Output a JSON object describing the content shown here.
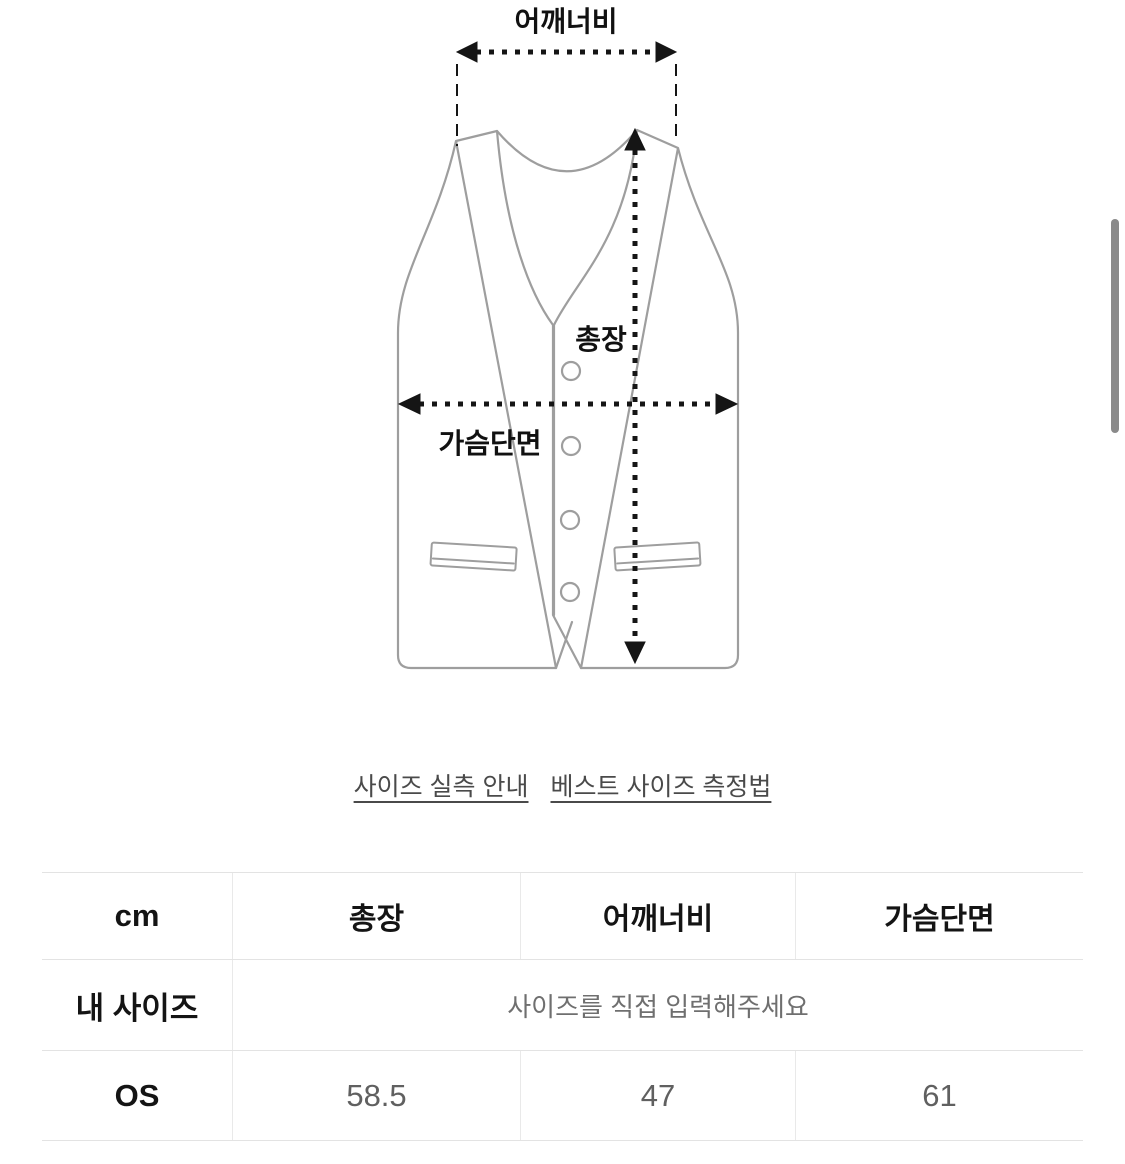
{
  "diagram": {
    "shoulder_label": "어깨너비",
    "length_label": "총장",
    "chest_label": "가슴단면"
  },
  "links": {
    "size_guide": "사이즈 실측 안내",
    "vest_measure": "베스트 사이즈 측정법"
  },
  "size_table": {
    "unit": "cm",
    "headers": [
      "총장",
      "어깨너비",
      "가슴단면"
    ],
    "my_size_label": "내 사이즈",
    "my_size_placeholder": "사이즈를 직접 입력해주세요",
    "rows": [
      {
        "label": "OS",
        "values": [
          "58.5",
          "47",
          "61"
        ]
      }
    ]
  },
  "colors": {
    "vest_outline": "#9e9e9e",
    "measure_line": "#151515",
    "table_border": "#e3e3e3",
    "value_text": "#606060",
    "hint_text": "#6f6f6f",
    "link_text": "#4a4a4a",
    "scrollbar": "#8a8a8a"
  }
}
